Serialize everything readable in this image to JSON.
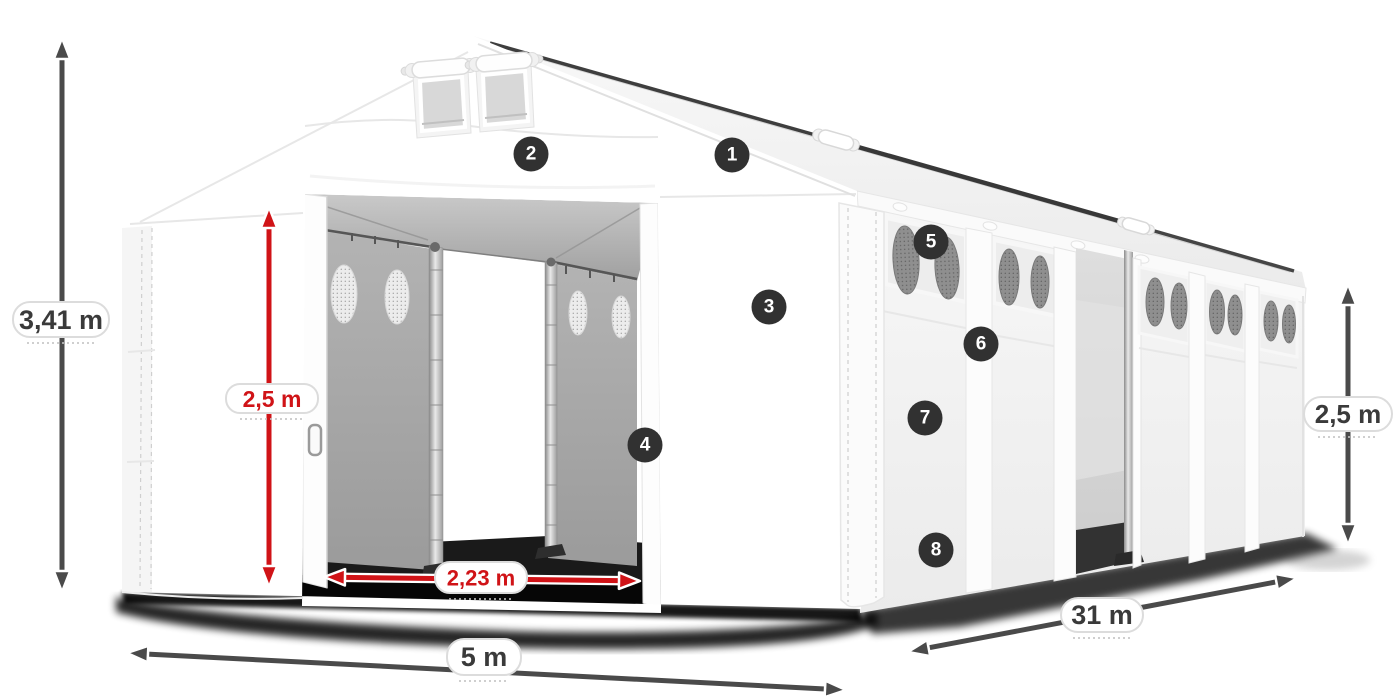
{
  "illustration_type": "tent-dimensions-diagram",
  "hotspots": {
    "markers": [
      "1",
      "2",
      "3",
      "4",
      "5",
      "6",
      "7",
      "8"
    ]
  },
  "dimensions": {
    "total_height": {
      "label": "3,41 m",
      "color": "#4a4a4a"
    },
    "door_height": {
      "label": "2,5 m",
      "color": "#d01317"
    },
    "door_width": {
      "label": "2,23 m",
      "color": "#d01317"
    },
    "front_width": {
      "label": "5 m",
      "color": "#4a4a4a"
    },
    "length": {
      "label": "31 m",
      "color": "#4a4a4a"
    },
    "side_height": {
      "label": "2,5 m",
      "color": "#4a4a4a"
    }
  },
  "colors": {
    "background": "#ffffff",
    "tent_fabric": "#ffffff",
    "interior_gray": "#a8a8a8",
    "ground_shadow": "#0a0a0a",
    "badge_background": "#313131",
    "badge_number": "#ffffff",
    "arrow_gray": "#4a4a4a",
    "arrow_red": "#d01317",
    "label_background": "#ffffff",
    "label_border": "#dcdcdc"
  }
}
